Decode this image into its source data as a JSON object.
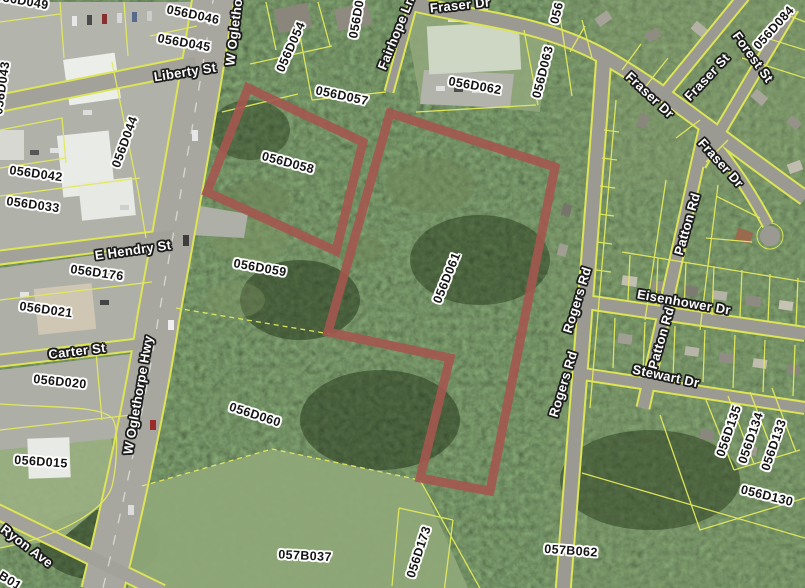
{
  "map": {
    "title": "County parcel viewer aerial map",
    "colors": {
      "highlight_outline": "#a4574f",
      "parcel_line": "#e3e95c",
      "road_fill": "#a2a29a",
      "canopy_base": "#2c421f"
    },
    "highlighted_parcels": [
      {
        "id": "056D058",
        "points": "248,88 363,142 336,251 207,192"
      },
      {
        "id": "056D061",
        "points": "390,113 555,167 490,491 420,478 450,358 328,332"
      }
    ],
    "labels": [
      {
        "text": "056D049",
        "x": 22,
        "y": 1,
        "r": 10,
        "kind": "parcel"
      },
      {
        "text": "056D046",
        "x": 193,
        "y": 15,
        "r": 12,
        "kind": "parcel"
      },
      {
        "text": "056D045",
        "x": 184,
        "y": 43,
        "r": 10,
        "kind": "parcel"
      },
      {
        "text": "056D044",
        "x": 125,
        "y": 142,
        "r": -70,
        "kind": "parcel"
      },
      {
        "text": "056D043",
        "x": 2,
        "y": 88,
        "r": -82,
        "kind": "parcel"
      },
      {
        "text": "056D042",
        "x": 36,
        "y": 174,
        "r": 8,
        "kind": "parcel"
      },
      {
        "text": "056D033",
        "x": 33,
        "y": 205,
        "r": 8,
        "kind": "parcel"
      },
      {
        "text": "056D176",
        "x": 97,
        "y": 273,
        "r": 8,
        "kind": "parcel"
      },
      {
        "text": "056D021",
        "x": 46,
        "y": 310,
        "r": 8,
        "kind": "parcel"
      },
      {
        "text": "056D020",
        "x": 60,
        "y": 382,
        "r": 6,
        "kind": "parcel"
      },
      {
        "text": "056D015",
        "x": 41,
        "y": 462,
        "r": 4,
        "kind": "parcel"
      },
      {
        "text": "B01",
        "x": 10,
        "y": 581,
        "r": 32,
        "kind": "parcel"
      },
      {
        "text": "056D054",
        "x": 291,
        "y": 47,
        "r": -66,
        "kind": "parcel"
      },
      {
        "text": "056D055",
        "x": 358,
        "y": 12,
        "r": -80,
        "kind": "parcel"
      },
      {
        "text": "056D057",
        "x": 342,
        "y": 96,
        "r": 12,
        "kind": "parcel"
      },
      {
        "text": "056D058",
        "x": 288,
        "y": 163,
        "r": 15,
        "kind": "parcel"
      },
      {
        "text": "056D059",
        "x": 260,
        "y": 268,
        "r": 10,
        "kind": "parcel"
      },
      {
        "text": "056D060",
        "x": 255,
        "y": 415,
        "r": 18,
        "kind": "parcel"
      },
      {
        "text": "056D061",
        "x": 447,
        "y": 278,
        "r": -68,
        "kind": "parcel"
      },
      {
        "text": "056D062",
        "x": 475,
        "y": 86,
        "r": 10,
        "kind": "parcel"
      },
      {
        "text": "056D063",
        "x": 543,
        "y": 72,
        "r": -76,
        "kind": "parcel"
      },
      {
        "text": "056",
        "x": 557,
        "y": 13,
        "r": -76,
        "kind": "parcel"
      },
      {
        "text": "056D084",
        "x": 774,
        "y": 28,
        "r": -48,
        "kind": "parcel"
      },
      {
        "text": "056D130",
        "x": 767,
        "y": 496,
        "r": 14,
        "kind": "parcel"
      },
      {
        "text": "056D133",
        "x": 774,
        "y": 445,
        "r": -71,
        "kind": "parcel"
      },
      {
        "text": "056D134",
        "x": 751,
        "y": 438,
        "r": -71,
        "kind": "parcel"
      },
      {
        "text": "056D135",
        "x": 729,
        "y": 431,
        "r": -71,
        "kind": "parcel"
      },
      {
        "text": "056D173",
        "x": 419,
        "y": 552,
        "r": -72,
        "kind": "parcel"
      },
      {
        "text": "057B037",
        "x": 305,
        "y": 556,
        "r": 3,
        "kind": "parcel"
      },
      {
        "text": "057B062",
        "x": 571,
        "y": 551,
        "r": 4,
        "kind": "parcel"
      },
      {
        "text": "Liberty St",
        "x": 185,
        "y": 72,
        "r": -9,
        "kind": "street"
      },
      {
        "text": "W Oglethorpe Hwy",
        "x": 237,
        "y": 6,
        "r": -83,
        "kind": "street"
      },
      {
        "text": "W Oglethorpe Hwy",
        "x": 138,
        "y": 395,
        "r": -80,
        "kind": "street"
      },
      {
        "text": "E Hendry St",
        "x": 133,
        "y": 250,
        "r": -8,
        "kind": "street"
      },
      {
        "text": "Carter St",
        "x": 77,
        "y": 351,
        "r": -7,
        "kind": "street"
      },
      {
        "text": "Ryon Ave",
        "x": 27,
        "y": 546,
        "r": 37,
        "kind": "street"
      },
      {
        "text": "Fairhope Ln",
        "x": 396,
        "y": 33,
        "r": -68,
        "kind": "street"
      },
      {
        "text": "Fraser Dr",
        "x": 460,
        "y": 5,
        "r": -6,
        "kind": "street"
      },
      {
        "text": "Fraser Dr",
        "x": 650,
        "y": 95,
        "r": 43,
        "kind": "street"
      },
      {
        "text": "Fraser St",
        "x": 707,
        "y": 77,
        "r": -47,
        "kind": "street"
      },
      {
        "text": "Forest St",
        "x": 753,
        "y": 57,
        "r": 54,
        "kind": "street"
      },
      {
        "text": "Fraser Dr",
        "x": 721,
        "y": 163,
        "r": 48,
        "kind": "street"
      },
      {
        "text": "Rogers Rd",
        "x": 577,
        "y": 300,
        "r": -73,
        "kind": "street"
      },
      {
        "text": "Rogers Rd",
        "x": 563,
        "y": 384,
        "r": -73,
        "kind": "street"
      },
      {
        "text": "Patton Rd",
        "x": 687,
        "y": 224,
        "r": -74,
        "kind": "street"
      },
      {
        "text": "Patton Rd",
        "x": 661,
        "y": 338,
        "r": -74,
        "kind": "street"
      },
      {
        "text": "Eisenhower Dr",
        "x": 684,
        "y": 302,
        "r": 10,
        "kind": "street"
      },
      {
        "text": "Stewart Dr",
        "x": 666,
        "y": 376,
        "r": 12,
        "kind": "street"
      }
    ]
  }
}
